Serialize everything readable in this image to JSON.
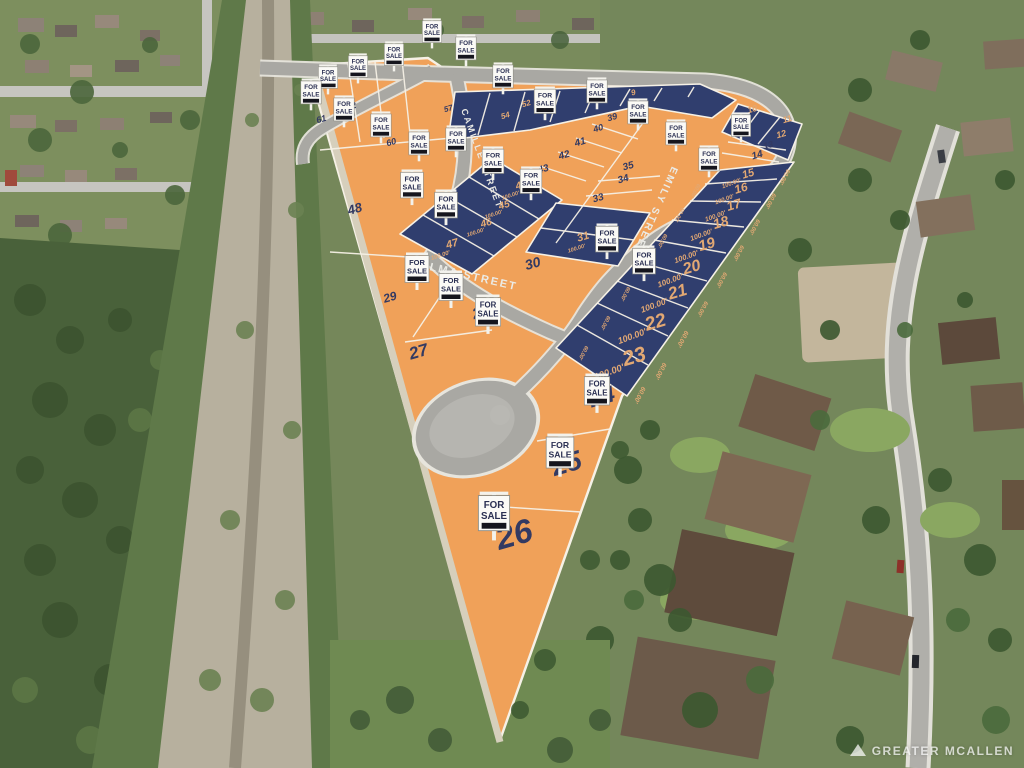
{
  "watermark": {
    "text": "GREATER MCALLEN",
    "icon": "mountain-logo"
  },
  "sign": {
    "line1": "FOR",
    "line2": "SALE"
  },
  "colors": {
    "lot_orange": "#f0a159",
    "lot_blue": "#303e6e",
    "lot_line": "#f6f1e6",
    "road": "#a9a8a3",
    "number_navy": "#333a62",
    "number_tan": "#e2a873",
    "street_text": "#ebebe6",
    "sign_face": "#fbfaf6",
    "sign_stripe": "#15151d",
    "sign_text": "#2a2f52"
  },
  "streets": [
    {
      "name": "CAMILLE STREET",
      "x": 461,
      "y": 110,
      "rotate": 70,
      "size": 9,
      "anchor": "start"
    },
    {
      "name": "ELMA STREET",
      "x": 420,
      "y": 268,
      "rotate": 13,
      "size": 11,
      "anchor": "start"
    },
    {
      "name": "EMILY STREET",
      "x": 672,
      "y": 166,
      "rotate": 114,
      "size": 10,
      "anchor": "start"
    }
  ],
  "lots": [
    {
      "number": "9",
      "x": 634,
      "y": 95,
      "size": 8,
      "shade": "blue"
    },
    {
      "number": "10",
      "x": 753,
      "y": 112,
      "size": 9,
      "shade": "blue"
    },
    {
      "number": "11",
      "x": 788,
      "y": 122,
      "size": 9,
      "shade": "blue"
    },
    {
      "number": "12",
      "x": 782,
      "y": 137,
      "size": 9,
      "shade": "blue"
    },
    {
      "number": "13",
      "x": 769,
      "y": 148,
      "size": 9,
      "shade": "orange"
    },
    {
      "number": "14",
      "x": 758,
      "y": 158,
      "size": 10,
      "shade": "orange"
    },
    {
      "number": "15",
      "x": 749,
      "y": 177,
      "size": 11,
      "shade": "blue"
    },
    {
      "number": "16",
      "x": 742,
      "y": 192,
      "size": 12,
      "shade": "blue"
    },
    {
      "number": "17",
      "x": 735,
      "y": 209,
      "size": 13,
      "shade": "blue"
    },
    {
      "number": "18",
      "x": 722,
      "y": 227,
      "size": 14,
      "shade": "blue"
    },
    {
      "number": "19",
      "x": 708,
      "y": 249,
      "size": 15,
      "shade": "blue"
    },
    {
      "number": "20",
      "x": 693,
      "y": 272,
      "size": 16,
      "shade": "blue"
    },
    {
      "number": "21",
      "x": 679,
      "y": 297,
      "size": 17,
      "shade": "blue"
    },
    {
      "number": "22",
      "x": 657,
      "y": 328,
      "size": 19,
      "shade": "blue"
    },
    {
      "number": "23",
      "x": 636,
      "y": 363,
      "size": 21,
      "shade": "blue"
    },
    {
      "number": "24",
      "x": 604,
      "y": 404,
      "size": 23,
      "shade": "orange"
    },
    {
      "number": "25",
      "x": 569,
      "y": 472,
      "size": 27,
      "shade": "orange"
    },
    {
      "number": "26",
      "x": 517,
      "y": 545,
      "size": 33,
      "shade": "orange"
    },
    {
      "number": "27",
      "x": 420,
      "y": 357,
      "size": 17,
      "shade": "orange"
    },
    {
      "number": "28",
      "x": 482,
      "y": 317,
      "size": 15,
      "shade": "orange"
    },
    {
      "number": "29",
      "x": 391,
      "y": 301,
      "size": 12,
      "shade": "orange"
    },
    {
      "number": "30",
      "x": 534,
      "y": 268,
      "size": 14,
      "shade": "orange"
    },
    {
      "number": "31",
      "x": 584,
      "y": 240,
      "size": 11,
      "shade": "blue"
    },
    {
      "number": "33",
      "x": 599,
      "y": 201,
      "size": 10,
      "shade": "orange"
    },
    {
      "number": "34",
      "x": 624,
      "y": 182,
      "size": 10,
      "shade": "orange"
    },
    {
      "number": "35",
      "x": 629,
      "y": 169,
      "size": 10,
      "shade": "orange"
    },
    {
      "number": "39",
      "x": 613,
      "y": 120,
      "size": 9,
      "shade": "orange"
    },
    {
      "number": "40",
      "x": 599,
      "y": 131,
      "size": 9,
      "shade": "orange"
    },
    {
      "number": "41",
      "x": 581,
      "y": 145,
      "size": 10,
      "shade": "orange"
    },
    {
      "number": "42",
      "x": 565,
      "y": 158,
      "size": 10,
      "shade": "orange"
    },
    {
      "number": "43",
      "x": 544,
      "y": 172,
      "size": 10,
      "shade": "orange"
    },
    {
      "number": "44",
      "x": 522,
      "y": 188,
      "size": 10,
      "shade": "blue"
    },
    {
      "number": "45",
      "x": 505,
      "y": 208,
      "size": 10,
      "shade": "blue"
    },
    {
      "number": "46",
      "x": 487,
      "y": 226,
      "size": 10,
      "shade": "blue"
    },
    {
      "number": "47",
      "x": 453,
      "y": 247,
      "size": 11,
      "shade": "blue"
    },
    {
      "number": "48",
      "x": 356,
      "y": 213,
      "size": 13,
      "shade": "orange"
    },
    {
      "number": "52",
      "x": 527,
      "y": 106,
      "size": 8,
      "shade": "blue"
    },
    {
      "number": "54",
      "x": 506,
      "y": 118,
      "size": 8,
      "shade": "blue"
    },
    {
      "number": "57",
      "x": 449,
      "y": 111,
      "size": 8,
      "shade": "orange"
    },
    {
      "number": "60",
      "x": 392,
      "y": 145,
      "size": 9,
      "shade": "orange"
    },
    {
      "number": "61",
      "x": 322,
      "y": 122,
      "size": 9,
      "shade": "orange"
    },
    {
      "number": "62",
      "x": 352,
      "y": 109,
      "size": 9,
      "shade": "orange"
    }
  ],
  "dimensions": [
    {
      "text": "100.00'",
      "x": 732,
      "y": 185,
      "rotate": -20,
      "size": 6
    },
    {
      "text": "100.00'",
      "x": 725,
      "y": 201,
      "rotate": -20,
      "size": 6
    },
    {
      "text": "100.00'",
      "x": 716,
      "y": 218,
      "rotate": -20,
      "size": 6.5
    },
    {
      "text": "100.00'",
      "x": 702,
      "y": 237,
      "rotate": -20,
      "size": 7
    },
    {
      "text": "100.00'",
      "x": 687,
      "y": 259,
      "rotate": -20,
      "size": 7.5
    },
    {
      "text": "100.00'",
      "x": 671,
      "y": 283,
      "rotate": -20,
      "size": 8
    },
    {
      "text": "100.00'",
      "x": 655,
      "y": 308,
      "rotate": -20,
      "size": 8.5
    },
    {
      "text": "100.00'",
      "x": 633,
      "y": 339,
      "rotate": -20,
      "size": 9
    },
    {
      "text": "100.00'",
      "x": 610,
      "y": 375,
      "rotate": -20,
      "size": 9.5
    },
    {
      "text": "100.00'",
      "x": 511,
      "y": 197,
      "rotate": -18,
      "size": 5.5
    },
    {
      "text": "100.00'",
      "x": 494,
      "y": 216,
      "rotate": -18,
      "size": 5.5
    },
    {
      "text": "100.00'",
      "x": 476,
      "y": 234,
      "rotate": -18,
      "size": 5.5
    },
    {
      "text": "100.00'",
      "x": 441,
      "y": 257,
      "rotate": -18,
      "size": 6
    },
    {
      "text": "100.00'",
      "x": 577,
      "y": 250,
      "rotate": -18,
      "size": 5.5
    },
    {
      "text": "60.00'",
      "x": 783,
      "y": 176,
      "rotate": 118,
      "size": 6
    },
    {
      "text": "60.00'",
      "x": 769,
      "y": 200,
      "rotate": 118,
      "size": 6
    },
    {
      "text": "60.00'",
      "x": 753,
      "y": 226,
      "rotate": 118,
      "size": 6
    },
    {
      "text": "60.00'",
      "x": 737,
      "y": 252,
      "rotate": 118,
      "size": 6
    },
    {
      "text": "60.00'",
      "x": 720,
      "y": 279,
      "rotate": 118,
      "size": 6
    },
    {
      "text": "60.00'",
      "x": 701,
      "y": 308,
      "rotate": 118,
      "size": 6
    },
    {
      "text": "60.00'",
      "x": 681,
      "y": 338,
      "rotate": 118,
      "size": 6.5
    },
    {
      "text": "60.00'",
      "x": 659,
      "y": 370,
      "rotate": 118,
      "size": 6.5
    },
    {
      "text": "60.00'",
      "x": 638,
      "y": 394,
      "rotate": 118,
      "size": 6.5
    },
    {
      "text": "60.00'",
      "x": 694,
      "y": 190,
      "rotate": 118,
      "size": 5.5
    },
    {
      "text": "60.00'",
      "x": 678,
      "y": 214,
      "rotate": 118,
      "size": 5.5
    },
    {
      "text": "60.00'",
      "x": 661,
      "y": 240,
      "rotate": 118,
      "size": 5.5
    },
    {
      "text": "60.00'",
      "x": 643,
      "y": 266,
      "rotate": 118,
      "size": 5.5
    },
    {
      "text": "60.00'",
      "x": 624,
      "y": 293,
      "rotate": 118,
      "size": 5.5
    },
    {
      "text": "60.00'",
      "x": 604,
      "y": 322,
      "rotate": 118,
      "size": 5.5
    },
    {
      "text": "60.00'",
      "x": 582,
      "y": 352,
      "rotate": 118,
      "size": 5.5
    }
  ],
  "signs": [
    {
      "x": 432,
      "y": 18,
      "scale": 0.8
    },
    {
      "x": 466,
      "y": 34,
      "scale": 0.85
    },
    {
      "x": 503,
      "y": 62,
      "scale": 0.85
    },
    {
      "x": 545,
      "y": 86,
      "scale": 0.9
    },
    {
      "x": 597,
      "y": 77,
      "scale": 0.85
    },
    {
      "x": 638,
      "y": 98,
      "scale": 0.85
    },
    {
      "x": 676,
      "y": 119,
      "scale": 0.85
    },
    {
      "x": 709,
      "y": 145,
      "scale": 0.85
    },
    {
      "x": 741,
      "y": 112,
      "scale": 0.8
    },
    {
      "x": 394,
      "y": 41,
      "scale": 0.8
    },
    {
      "x": 358,
      "y": 53,
      "scale": 0.8
    },
    {
      "x": 328,
      "y": 64,
      "scale": 0.8
    },
    {
      "x": 311,
      "y": 78,
      "scale": 0.85
    },
    {
      "x": 344,
      "y": 95,
      "scale": 0.85
    },
    {
      "x": 381,
      "y": 111,
      "scale": 0.85
    },
    {
      "x": 419,
      "y": 129,
      "scale": 0.85
    },
    {
      "x": 456,
      "y": 125,
      "scale": 0.85
    },
    {
      "x": 493,
      "y": 146,
      "scale": 0.9
    },
    {
      "x": 531,
      "y": 166,
      "scale": 0.9
    },
    {
      "x": 412,
      "y": 169,
      "scale": 0.95
    },
    {
      "x": 446,
      "y": 189,
      "scale": 0.95
    },
    {
      "x": 417,
      "y": 252,
      "scale": 1.0
    },
    {
      "x": 451,
      "y": 270,
      "scale": 1.0
    },
    {
      "x": 488,
      "y": 294,
      "scale": 1.05
    },
    {
      "x": 607,
      "y": 223,
      "scale": 0.95
    },
    {
      "x": 644,
      "y": 245,
      "scale": 0.95
    },
    {
      "x": 597,
      "y": 373,
      "scale": 1.05
    },
    {
      "x": 560,
      "y": 433,
      "scale": 1.15
    },
    {
      "x": 494,
      "y": 491,
      "scale": 1.3
    }
  ]
}
